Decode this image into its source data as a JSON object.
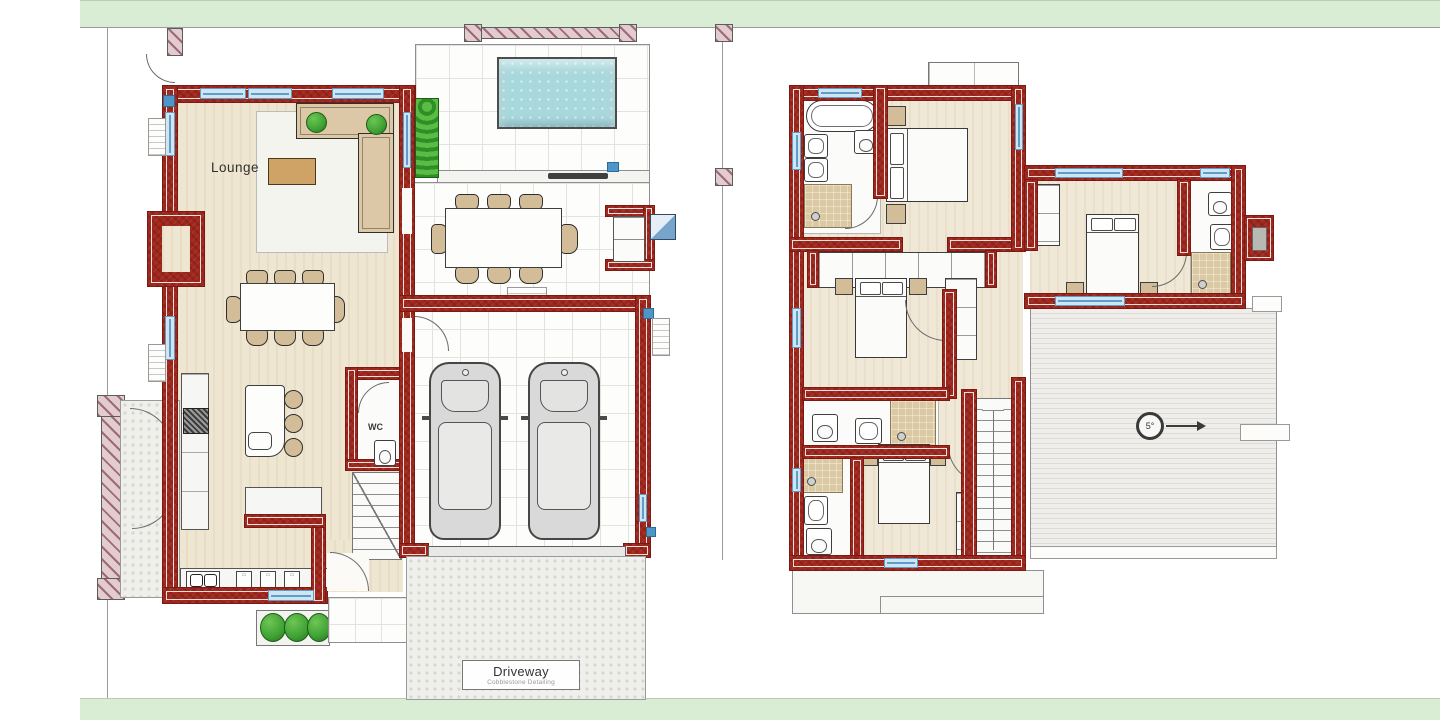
{
  "labels": {
    "lounge": "Lounge",
    "wc": "WC",
    "driveway_title": "Driveway",
    "driveway_subtitle": "Cobblestone Detailing",
    "roof_slope_degrees": "5°"
  },
  "colors": {
    "site-green": "#d9edd4",
    "boundary-gray": "#9a9a9a",
    "wall-red": "#a1271d",
    "wall-red-dark": "#7a1a12",
    "hatch-pink": "#e3ccd0",
    "hatch-stroke": "#9c6b75",
    "floor-beige": "#efe6d2",
    "tile-line": "#e2e2df",
    "pool-cyan": "#a9d8dc",
    "window-blue": "#5f9dc9",
    "window-light": "#cfe6f2",
    "greenery": "#3fa234",
    "furniture-tan": "#d3bd98",
    "wood-brown": "#cfa265",
    "roof-stripe": "#dcdbd7",
    "car-gray": "#d9d9d9"
  }
}
